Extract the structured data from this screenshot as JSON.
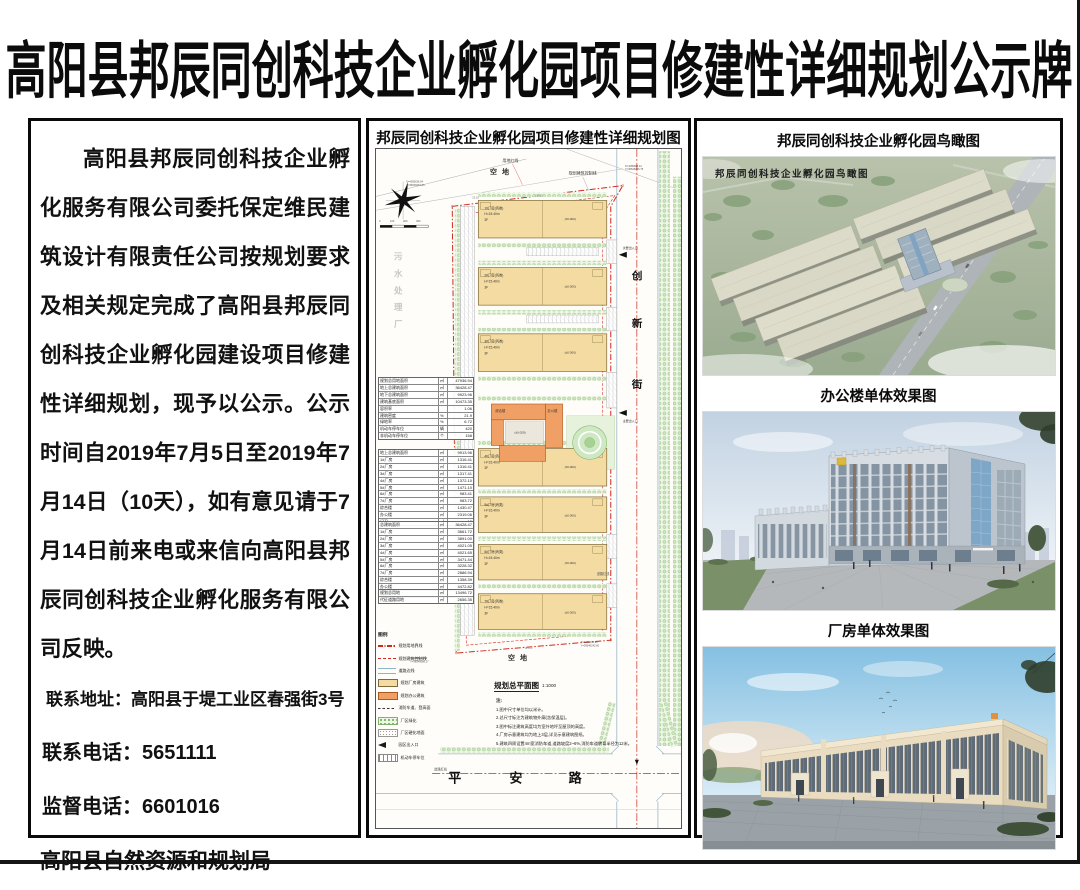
{
  "poster": {
    "title": "高阳县邦辰同创科技企业孵化园项目修建性详细规划公示牌"
  },
  "notice": {
    "paragraph": "高阳县邦辰同创科技企业孵化服务有限公司委托保定维民建筑设计有限责任公司按规划要求及相关规定完成了高阳县邦辰同创科技企业孵化园建设项目修建性详细规划，现予以公示。公示时间自2019年7月5日至2019年7月14日（10天），如有意见请于7月14日前来电或来信向高阳县邦辰同创科技企业孵化服务有限公司反映。",
    "address": "联系地址：高阳县于堤工业区春强街3号",
    "phone": "联系电话：5651111",
    "supervise": "监督电话：6601016",
    "agency": "高阳县自然资源和规划局"
  },
  "plan": {
    "title": "邦辰同创科技企业孵化园项目修建性详细规划图",
    "caption": "规划总平面图",
    "scale": "1:1000",
    "vacant_top": "空地",
    "vacant_bottom": "空地",
    "land_red_line": "用地红线",
    "control_line": "规划建筑控制线",
    "road_red_line_e": "道路红线",
    "road_red_line_s": "道路红线",
    "entr_secondary": "次要出入口",
    "entr_main": "主要出入口",
    "sewage_chars": [
      "污",
      "水",
      "处",
      "理",
      "厂"
    ],
    "street_east_chars": [
      "创",
      "新",
      "街"
    ],
    "street_south_chars": [
      "平",
      "安",
      "路"
    ],
    "scale_ticks": [
      "0",
      "100",
      "200",
      "300"
    ],
    "dims": [
      "25.20",
      "128.00",
      "123.23"
    ],
    "coords": [
      [
        "X=4285636.04",
        "Y=39546081.86"
      ],
      [
        "X=4285698.12",
        "Y=39546236.75"
      ],
      [
        "X=4285210.35",
        "Y=39546088.17"
      ],
      [
        "X=4285246.90",
        "Y=39546242.60"
      ]
    ],
    "buildings": [
      {
        "name": "1#厂房(丙类)",
        "h": "H=15.40m",
        "f": "3F",
        "elev": "(±0.000)"
      },
      {
        "name": "2#厂房(丙类)",
        "h": "H=15.40m",
        "f": "3F",
        "elev": "(±0.000)"
      },
      {
        "name": "3#厂房(丙类)",
        "h": "H=15.40m",
        "f": "3F",
        "elev": "(±0.000)"
      },
      {
        "name": "4#厂房(丙类)",
        "h": "H=15.40m",
        "f": "3F",
        "elev": "(±0.000)"
      },
      {
        "name": "5#厂房(丙类)",
        "h": "H=15.40m",
        "f": "3F",
        "elev": "(±0.000)"
      },
      {
        "name": "6#厂房(丙类)",
        "h": "H=15.40m",
        "f": "3F",
        "elev": "(±0.000)"
      },
      {
        "name": "7#厂房(丙类)",
        "h": "H=15.40m",
        "f": "3F",
        "elev": "(±0.000)"
      }
    ],
    "office": {
      "a": "综合楼",
      "b": "办公楼",
      "elev": "(±0.000)"
    },
    "legend": {
      "title": "图例",
      "items": [
        "规划用地界线",
        "规划建筑控制线",
        "道路边线",
        "规划厂房建筑",
        "规划办公建筑",
        "消防车道、登高面",
        "厂区绿化",
        "厂区硬化地面",
        "园区出入口",
        "机动车停车位"
      ]
    },
    "notes": {
      "title": "注:",
      "lines": [
        "1.图中尺寸单位均以米计。",
        "2.总尺寸标注为建筑物外廓(含保温层)。",
        "3.图中标注建筑高度均为室外地坪至屋顶的高度。",
        "4.厂房示意建筑均为地上3层,详见示意建筑图纸。",
        "5.建筑四周设置4m宽消防车道,道路坡度2~6%,消防车道转弯半径为12米。"
      ]
    },
    "tables": [
      {
        "rows": [
          [
            "规划总用地面积",
            "㎡",
            "47936.94"
          ],
          [
            "地上总建筑面积",
            "㎡",
            "36428.47"
          ],
          [
            "地下总建筑面积",
            "㎡",
            "9923.96"
          ],
          [
            "建筑基底面积",
            "㎡",
            "10473.35"
          ],
          [
            "容积率",
            "",
            "1.06"
          ],
          [
            "建筑密度",
            "%",
            "21.9"
          ],
          [
            "绿地率",
            "%",
            "6.72"
          ],
          [
            "机动车停车位",
            "辆",
            "420"
          ],
          [
            "非机动车停车位",
            "个",
            "158"
          ]
        ]
      },
      {
        "rows": [
          [
            "地上总建筑面积",
            "㎡",
            "9913.96"
          ],
          [
            "1#厂房",
            "㎡",
            "1316.41"
          ],
          [
            "2#厂房",
            "㎡",
            "1316.41"
          ],
          [
            "3#厂房",
            "㎡",
            "1317.41"
          ],
          [
            "4#厂房",
            "㎡",
            "1372.10"
          ],
          [
            "5#厂房",
            "㎡",
            "1471.10"
          ],
          [
            "6#厂房",
            "㎡",
            "983.41"
          ],
          [
            "7#厂房",
            "㎡",
            "983.72"
          ],
          [
            "综合楼",
            "㎡",
            "1430.47"
          ],
          [
            "办公楼",
            "㎡",
            "2319.06"
          ],
          [
            "门卫",
            "㎡",
            "12"
          ]
        ]
      },
      {
        "rows": [
          [
            "总建筑面积",
            "㎡",
            "36428.47"
          ],
          [
            "1#厂房",
            "㎡",
            "3661.72"
          ],
          [
            "2#厂房",
            "㎡",
            "3891.00"
          ],
          [
            "3#厂房",
            "㎡",
            "4021.05"
          ],
          [
            "4#厂房",
            "㎡",
            "4021.65"
          ],
          [
            "5#厂房",
            "㎡",
            "3471.44"
          ],
          [
            "6#厂房",
            "㎡",
            "3228.32"
          ],
          [
            "7#厂房",
            "㎡",
            "2886.94"
          ],
          [
            "综合楼",
            "㎡",
            "1358.39"
          ],
          [
            "办公楼",
            "㎡",
            "4472.82"
          ],
          [
            "门卫",
            "㎡",
            "12"
          ]
        ]
      },
      {
        "rows": [
          [
            "规划总用地",
            "㎡",
            "13496.72"
          ],
          [
            "代征道路用地",
            "㎡",
            "2656.35"
          ]
        ]
      }
    ]
  },
  "renders": {
    "sections": [
      {
        "title": "邦辰同创科技企业孵化园鸟瞰图",
        "overlay": "邦辰同创科技企业孵化园鸟瞰图"
      },
      {
        "title": "办公楼单体效果图"
      },
      {
        "title": "厂房单体效果图"
      }
    ]
  }
}
